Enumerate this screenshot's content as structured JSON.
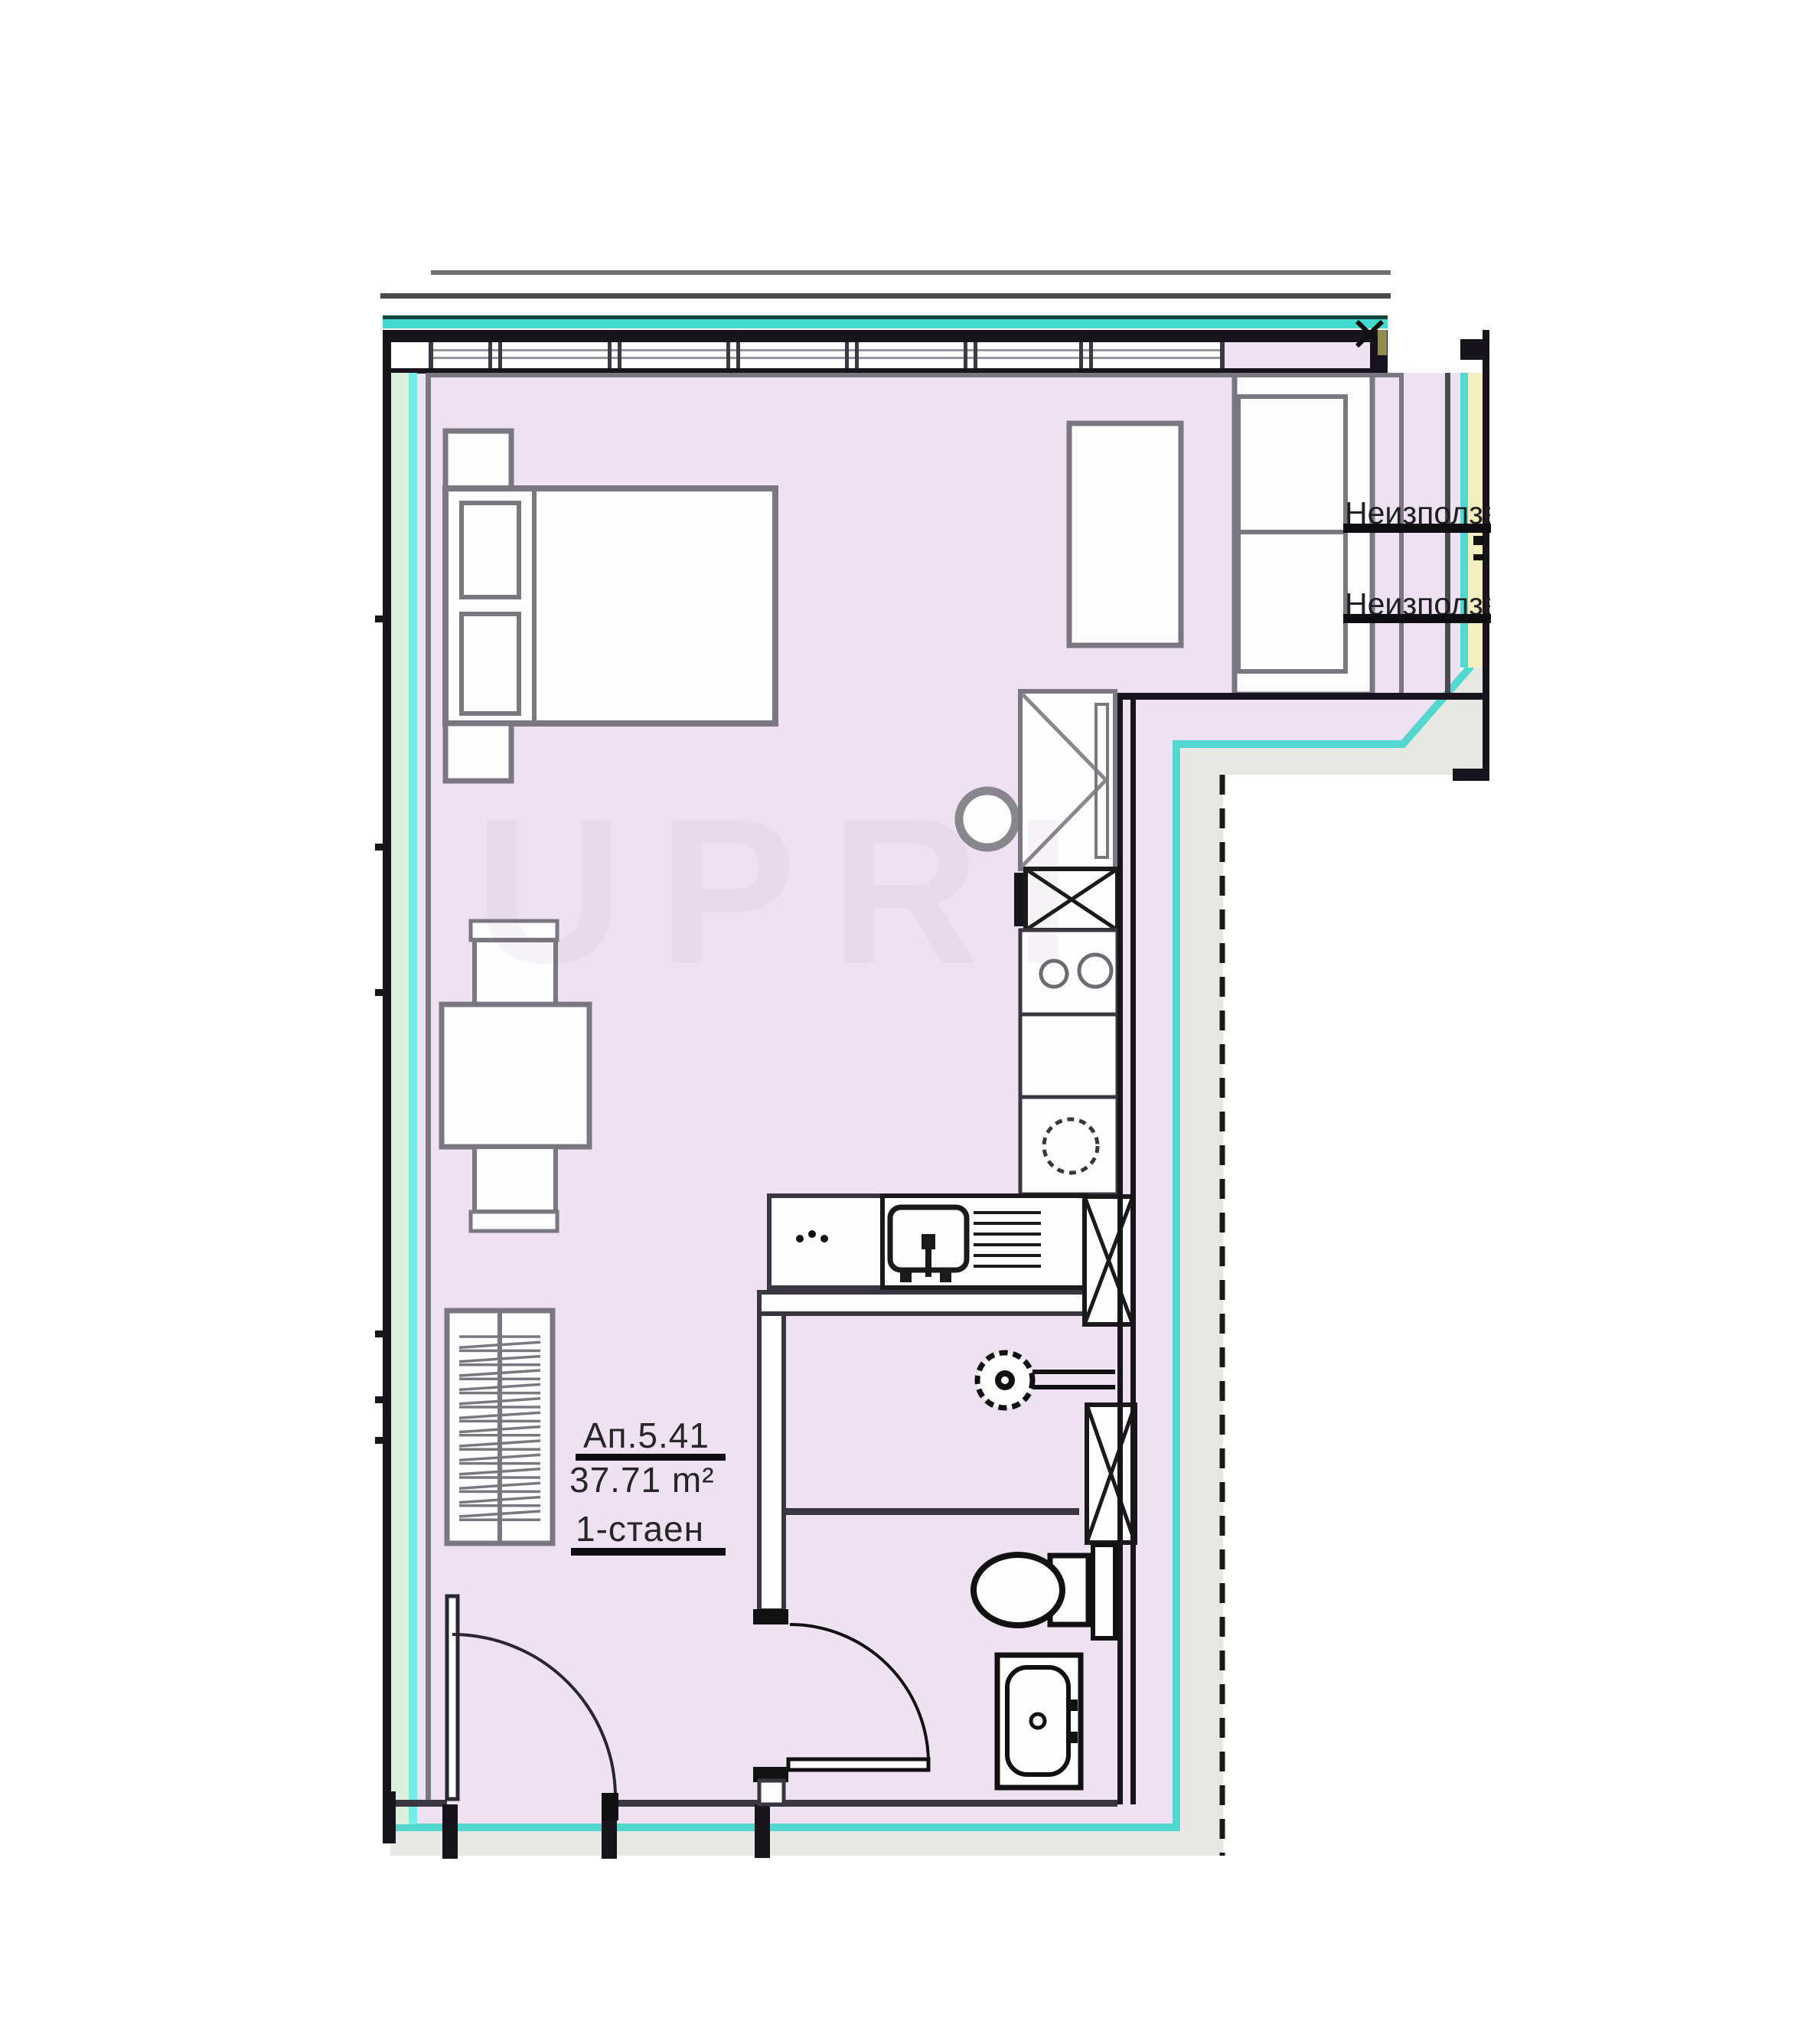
{
  "apartment": {
    "number": "Ап.5.41",
    "area": "37.71 m²",
    "type": "1-стаен"
  },
  "annotations": {
    "unused_area_1": "Неизползваема",
    "unused_area_2": "Неизползваема"
  },
  "watermark": "UPRI",
  "colors": {
    "floor": "#eee1f2",
    "wall": "#17141b",
    "dark_line": "#3a3640",
    "furniture_line": "#7b7780",
    "furniture_fill": "#fdfcfe",
    "teal": "#43d9ce",
    "teal_dark": "#12443c",
    "green": "#dcf0de",
    "cyan_line": "#76ece6",
    "boundary_cyan": "#52d8ce",
    "yellow": "#f3eec0",
    "olive": "#8f8c52",
    "terrace": "#e7e7e4",
    "text": "#262626"
  }
}
